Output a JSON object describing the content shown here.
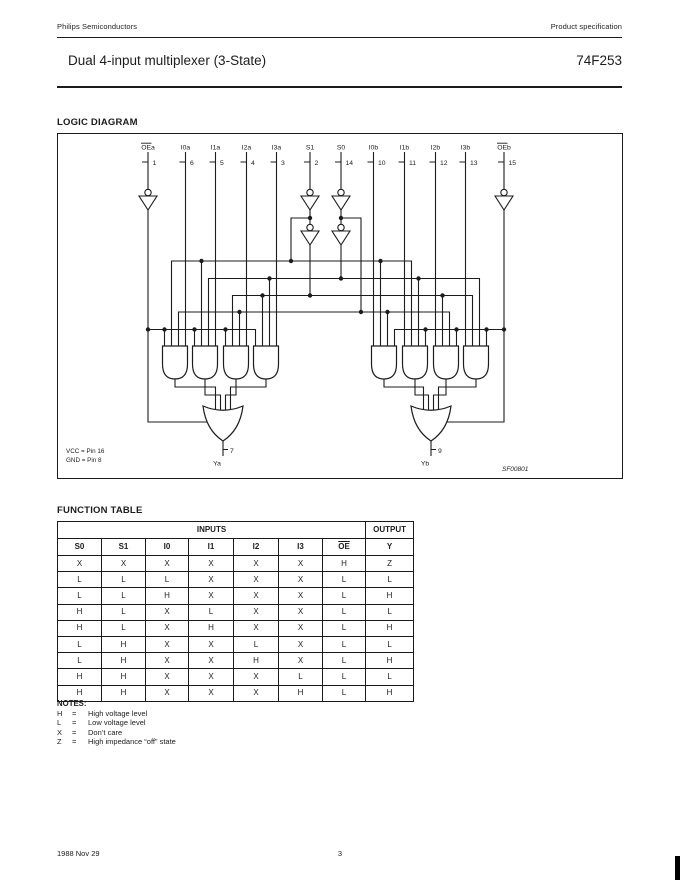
{
  "page": {
    "header_left": "Philips Semiconductors",
    "header_right": "Product specification",
    "title": "Dual 4-input multiplexer (3-State)",
    "part_number": "74F253",
    "footer_date": "1988 Nov 29",
    "footer_page": "3"
  },
  "logic_diagram": {
    "heading": "LOGIC DIAGRAM",
    "inputs": [
      {
        "label": "OEa",
        "pin": "1",
        "overline": true
      },
      {
        "label": "I0a",
        "pin": "6",
        "overline": false
      },
      {
        "label": "I1a",
        "pin": "5",
        "overline": false
      },
      {
        "label": "I2a",
        "pin": "4",
        "overline": false
      },
      {
        "label": "I3a",
        "pin": "3",
        "overline": false
      },
      {
        "label": "S1",
        "pin": "2",
        "overline": false
      },
      {
        "label": "S0",
        "pin": "14",
        "overline": false
      },
      {
        "label": "I0b",
        "pin": "10",
        "overline": false
      },
      {
        "label": "I1b",
        "pin": "11",
        "overline": false
      },
      {
        "label": "I2b",
        "pin": "12",
        "overline": false
      },
      {
        "label": "I3b",
        "pin": "13",
        "overline": false
      },
      {
        "label": "OEb",
        "pin": "15",
        "overline": true
      }
    ],
    "outputs": [
      {
        "label": "Ya",
        "pin": "7"
      },
      {
        "label": "Yb",
        "pin": "9"
      }
    ],
    "vcc_note": "VCC = Pin 16",
    "gnd_note": "GND = Pin 8",
    "figure_code": "SF00801"
  },
  "function_table": {
    "heading": "FUNCTION TABLE",
    "group_headers": [
      {
        "label": "INPUTS",
        "span": 7
      },
      {
        "label": "OUTPUT",
        "span": 1
      }
    ],
    "columns": [
      {
        "label": "S0",
        "overline": false
      },
      {
        "label": "S1",
        "overline": false
      },
      {
        "label": "I0",
        "overline": false
      },
      {
        "label": "I1",
        "overline": false
      },
      {
        "label": "I2",
        "overline": false
      },
      {
        "label": "I3",
        "overline": false
      },
      {
        "label": "OE",
        "overline": true
      },
      {
        "label": "Y",
        "overline": false
      }
    ],
    "rows": [
      [
        "X",
        "X",
        "X",
        "X",
        "X",
        "X",
        "H",
        "Z"
      ],
      [
        "L",
        "L",
        "L",
        "X",
        "X",
        "X",
        "L",
        "L"
      ],
      [
        "L",
        "L",
        "H",
        "X",
        "X",
        "X",
        "L",
        "H"
      ],
      [
        "H",
        "L",
        "X",
        "L",
        "X",
        "X",
        "L",
        "L"
      ],
      [
        "H",
        "L",
        "X",
        "H",
        "X",
        "X",
        "L",
        "H"
      ],
      [
        "L",
        "H",
        "X",
        "X",
        "L",
        "X",
        "L",
        "L"
      ],
      [
        "L",
        "H",
        "X",
        "X",
        "H",
        "X",
        "L",
        "H"
      ],
      [
        "H",
        "H",
        "X",
        "X",
        "X",
        "L",
        "L",
        "L"
      ],
      [
        "H",
        "H",
        "X",
        "X",
        "X",
        "H",
        "L",
        "H"
      ]
    ]
  },
  "notes": {
    "heading": "NOTES:",
    "items": [
      {
        "symbol": "H",
        "equals": "=",
        "definition": "High voltage level"
      },
      {
        "symbol": "L",
        "equals": "=",
        "definition": "Low voltage level"
      },
      {
        "symbol": "X",
        "equals": "=",
        "definition": "Don’t care"
      },
      {
        "symbol": "Z",
        "equals": "=",
        "definition": "High impedance “off” state"
      }
    ]
  }
}
